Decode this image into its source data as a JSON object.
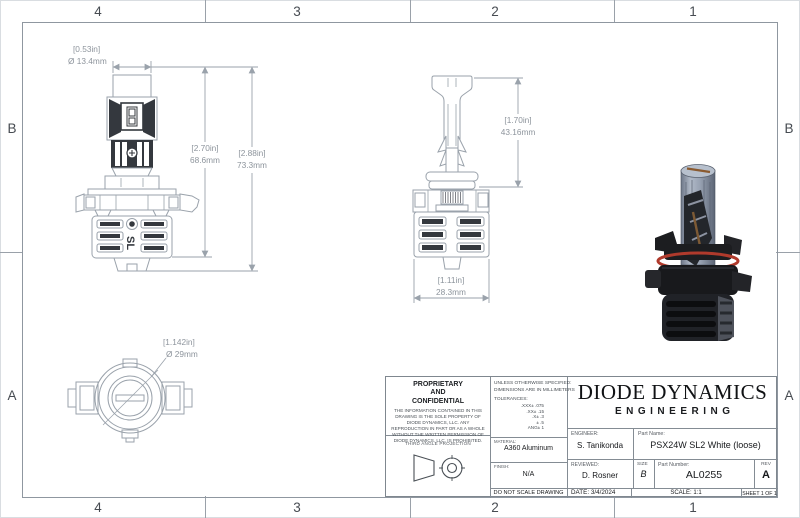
{
  "sheet": {
    "zones": {
      "top": [
        "4",
        "3",
        "2",
        "1"
      ],
      "bottom": [
        "4",
        "3",
        "2",
        "1"
      ],
      "left": [
        "B",
        "A"
      ],
      "right": [
        "B",
        "A"
      ]
    }
  },
  "views": {
    "front": {
      "dim_diameter_in": "[0.53in]",
      "dim_diameter_mm": "Ø 13.4mm",
      "dim_h1_in": "[2.70in]",
      "dim_h1_mm": "68.6mm",
      "dim_h2_in": "[2.88in]",
      "dim_h2_mm": "73.3mm",
      "logo": "SL"
    },
    "side": {
      "dim_height_in": "[1.70in]",
      "dim_height_mm": "43.16mm",
      "dim_width_in": "[1.11in]",
      "dim_width_mm": "28.3mm"
    },
    "bottom": {
      "dim_diameter_in": "[1.142in]",
      "dim_diameter_mm": "Ø 29mm"
    }
  },
  "colors": {
    "drawing_line": "#9aa2ab",
    "aluminum_silver": "#9aa3b4",
    "body_black": "#1c1d20",
    "oring_red": "#b03a2c"
  },
  "title_block": {
    "proprietary": {
      "heading": "PROPRIETARY AND CONFIDENTIAL",
      "body": "THE INFORMATION CONTAINED IN THIS DRAWING IS THE SOLE PROPERTY OF DIODE DYNAMICS, LLC.  ANY REPRODUCTION IN PART OR AS A WHOLE WITHOUT THE WRITTEN PERMISSION OF DIODE DYNAMICS, LLC. IS PROHIBITED."
    },
    "projection_label": "THIRD ANGLE PROJECTION",
    "specs": {
      "line1": "UNLESS OTHERWISE SPECIFIED:",
      "line2": "DIMENSIONS ARE IN MILLIMETERS",
      "tolerances_label": "TOLERANCES:",
      "tolerances": [
        ".XXX± .075",
        ".XX± .15",
        ".X± .3",
        "± .5",
        "ANG± 1"
      ]
    },
    "material": {
      "label": "MATERIAL:",
      "value": "A360 Aluminum"
    },
    "finish": {
      "label": "FINISH:",
      "value": "N/A"
    },
    "do_not_scale": "DO NOT SCALE DRAWING",
    "company": {
      "name": "DIODE DYNAMICS",
      "division": "ENGINEERING"
    },
    "engineer": {
      "label": "ENGINEER:",
      "value": "S. Tanikonda"
    },
    "reviewed": {
      "label": "REVIEWED:",
      "value": "D. Rosner"
    },
    "date": {
      "label": "DATE:",
      "value": "3/4/2024"
    },
    "part_name": {
      "label": "Part Name:",
      "value": "PSX24W SL2 White (loose)"
    },
    "size": {
      "label": "SIZE",
      "value": "B"
    },
    "part_number": {
      "label": "Part Number:",
      "value": "AL0255"
    },
    "rev": {
      "label": "REV",
      "value": "A"
    },
    "scale_label": "SCALE: 1:1",
    "sheet_label": "SHEET 1 OF 1"
  }
}
